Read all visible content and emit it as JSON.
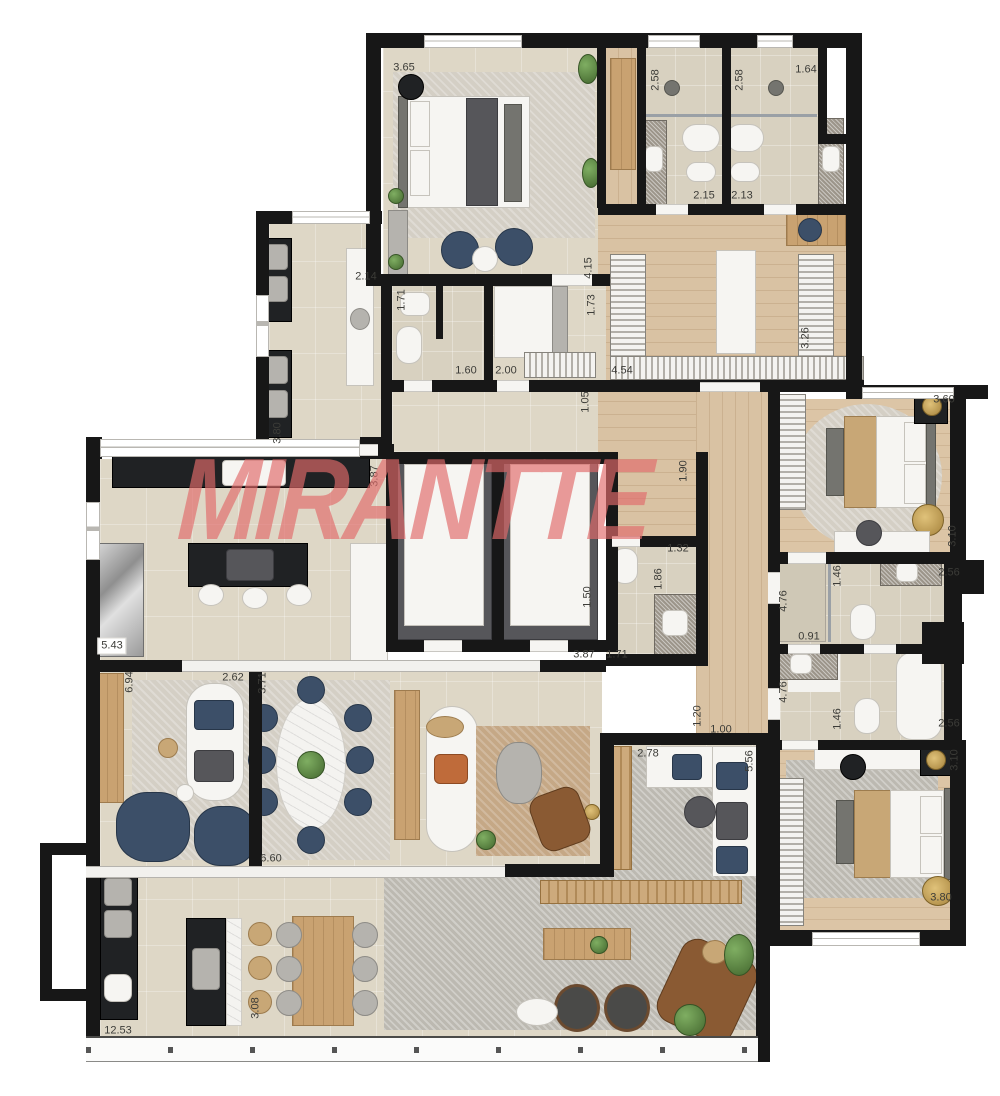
{
  "watermark": {
    "text": "MIRANTTE",
    "color": "#e26b6b"
  },
  "palette": {
    "wall": "#171717",
    "tile_floor": "#ded7c6",
    "wood_floor": "#d9c2a3",
    "watermark_red": "#e26b6b"
  },
  "dimension_labels": [
    {
      "t": "3.65",
      "x": 404,
      "y": 68
    },
    {
      "t": "2.58",
      "x": 656,
      "y": 80,
      "v": 1
    },
    {
      "t": "2.58",
      "x": 740,
      "y": 80,
      "v": 1
    },
    {
      "t": "1.64",
      "x": 806,
      "y": 70
    },
    {
      "t": "2.15",
      "x": 704,
      "y": 196
    },
    {
      "t": "2.13",
      "x": 742,
      "y": 196
    },
    {
      "t": "4.15",
      "x": 589,
      "y": 268,
      "v": 1
    },
    {
      "t": "3.26",
      "x": 806,
      "y": 338,
      "v": 1
    },
    {
      "t": "2.14",
      "x": 366,
      "y": 277
    },
    {
      "t": "1.71",
      "x": 402,
      "y": 300,
      "v": 1
    },
    {
      "t": "1.73",
      "x": 592,
      "y": 305,
      "v": 1
    },
    {
      "t": "1.60",
      "x": 466,
      "y": 371
    },
    {
      "t": "2.00",
      "x": 506,
      "y": 371
    },
    {
      "t": "4.54",
      "x": 622,
      "y": 371
    },
    {
      "t": "1.05",
      "x": 586,
      "y": 402,
      "v": 1
    },
    {
      "t": "3.80",
      "x": 278,
      "y": 433,
      "v": 1
    },
    {
      "t": "3.87",
      "x": 375,
      "y": 476,
      "v": 1
    },
    {
      "t": "1.90",
      "x": 684,
      "y": 471,
      "v": 1
    },
    {
      "t": "3.60",
      "x": 944,
      "y": 400
    },
    {
      "t": "3.10",
      "x": 953,
      "y": 536,
      "v": 1
    },
    {
      "t": "1.32",
      "x": 678,
      "y": 549
    },
    {
      "t": "1.86",
      "x": 659,
      "y": 579,
      "v": 1
    },
    {
      "t": "1.50",
      "x": 588,
      "y": 597,
      "v": 1
    },
    {
      "t": "5.43",
      "x": 112,
      "y": 646,
      "bg": 1
    },
    {
      "t": "3.87",
      "x": 584,
      "y": 655
    },
    {
      "t": "1.71",
      "x": 617,
      "y": 655
    },
    {
      "t": "2.56",
      "x": 949,
      "y": 573
    },
    {
      "t": "1.46",
      "x": 838,
      "y": 576,
      "v": 1
    },
    {
      "t": "4.76",
      "x": 784,
      "y": 601,
      "v": 1
    },
    {
      "t": "0.91",
      "x": 809,
      "y": 637
    },
    {
      "t": "4.76",
      "x": 784,
      "y": 692,
      "v": 1
    },
    {
      "t": "1.46",
      "x": 838,
      "y": 719,
      "v": 1
    },
    {
      "t": "2.56",
      "x": 949,
      "y": 724
    },
    {
      "t": "6.94",
      "x": 130,
      "y": 682,
      "v": 1
    },
    {
      "t": "2.62",
      "x": 233,
      "y": 678
    },
    {
      "t": "3.71",
      "x": 263,
      "y": 683,
      "v": 1
    },
    {
      "t": "6.60",
      "x": 271,
      "y": 859
    },
    {
      "t": "1.20",
      "x": 698,
      "y": 716,
      "v": 1
    },
    {
      "t": "1.00",
      "x": 721,
      "y": 730
    },
    {
      "t": "2.78",
      "x": 648,
      "y": 754
    },
    {
      "t": "5.56",
      "x": 750,
      "y": 761,
      "v": 1
    },
    {
      "t": "3.10",
      "x": 955,
      "y": 760,
      "v": 1
    },
    {
      "t": "3.80",
      "x": 941,
      "y": 898
    },
    {
      "t": "12.53",
      "x": 118,
      "y": 1031
    },
    {
      "t": "3.08",
      "x": 256,
      "y": 1008,
      "v": 1
    }
  ]
}
